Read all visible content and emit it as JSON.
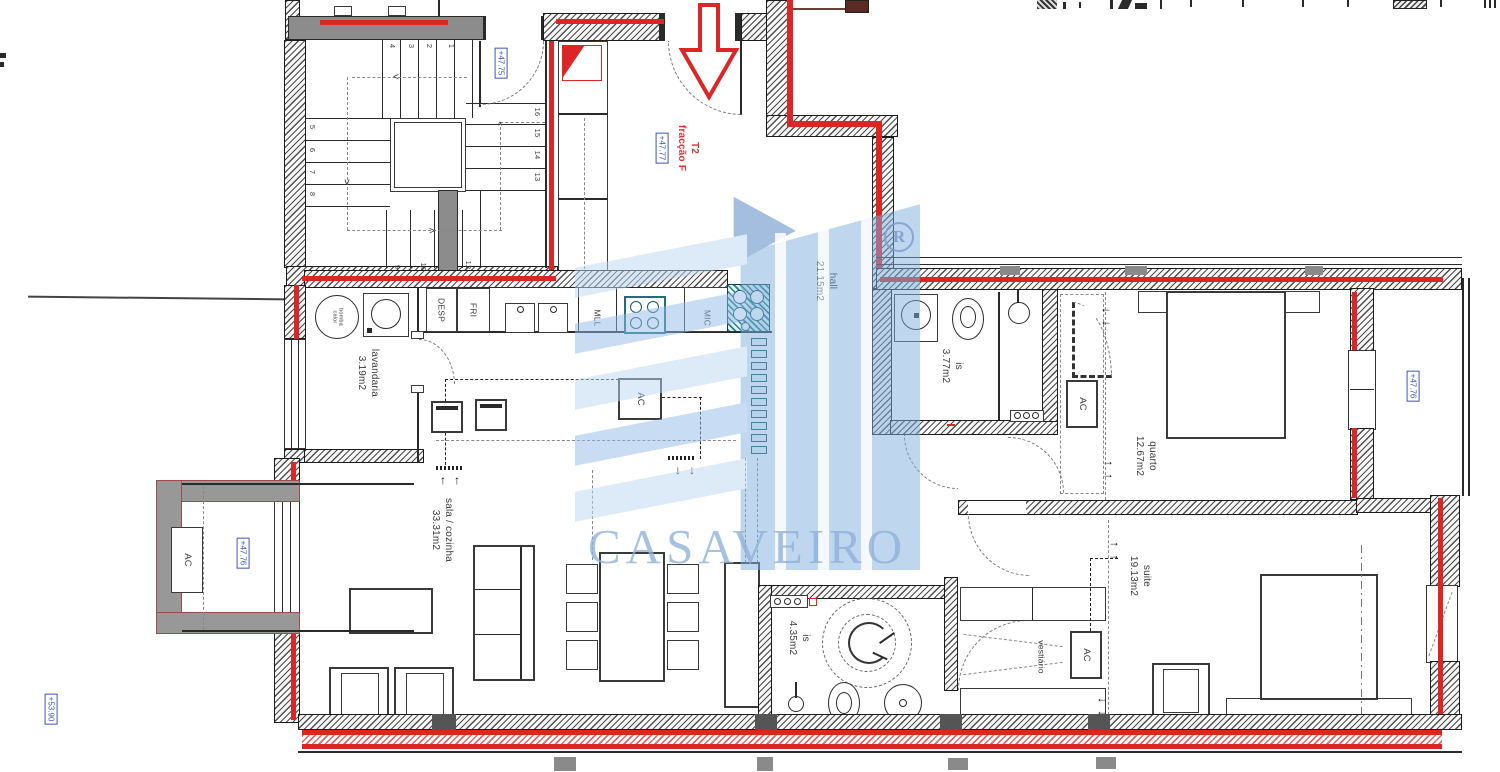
{
  "plan": {
    "unit_label": "T2",
    "fraction_label": "fracção F",
    "levels": {
      "stair_landing": "+47.75",
      "hall": "+47.77",
      "terrace": "+47.76",
      "balcony": "+47.76",
      "roof": "+53.90"
    },
    "rooms": {
      "hall": {
        "name": "hall",
        "area": "21.15m2"
      },
      "lavandaria": {
        "name": "lavandaria",
        "area": "3.19m2"
      },
      "sala": {
        "name": "sala / cozinha",
        "area": "33.31m2"
      },
      "is1": {
        "name": "is",
        "area": "3.77m2"
      },
      "quarto": {
        "name": "quarto",
        "area": "12.67m2"
      },
      "is2": {
        "name": "is",
        "area": "4.35m2"
      },
      "suite": {
        "name": "suite",
        "area": "19.13m2"
      },
      "vestiario": {
        "name": "vestiário"
      }
    },
    "equipment": {
      "ac": "AC",
      "desp": "DESP",
      "fri": "FRI",
      "mll": "MLL",
      "mic": "MIC",
      "bomba_line1": "bomba",
      "bomba_line2": "calor"
    },
    "stairs": {
      "steps": [
        "1",
        "2",
        "3",
        "4",
        "5",
        "6",
        "7",
        "8",
        "9",
        "10",
        "12",
        "13",
        "14",
        "15",
        "16"
      ]
    }
  },
  "watermark": {
    "brand": "CASAVEIRO",
    "registered": "R"
  },
  "icons": {
    "arrow_up": "↑",
    "arrow_down": "↓",
    "arrow_left": "←",
    "arrow_right": "→",
    "chevron_left": "<",
    "chevron_right": ">",
    "chevron_up": "^",
    "chevron_down": "v"
  },
  "colors": {
    "duct_red": "#dc2626",
    "marker_blue": "#3d55b8",
    "title_red": "#e03030",
    "watermark_blue": "#8fb0d9",
    "wall_gray": "#8c8c8c",
    "stove_teal": "#1d6f78"
  }
}
